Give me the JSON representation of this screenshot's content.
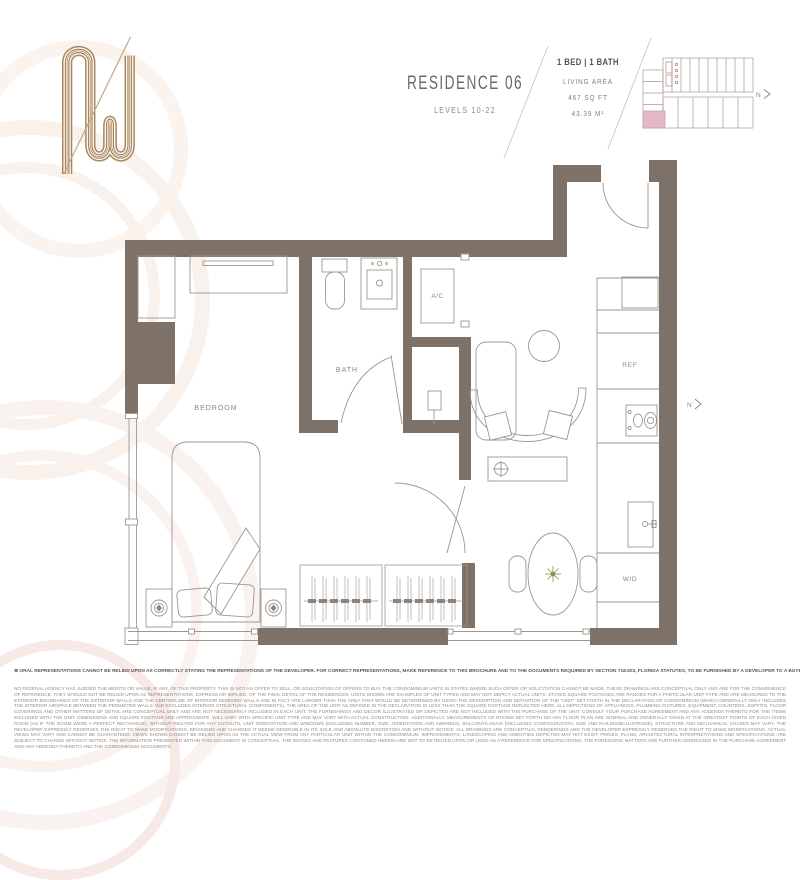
{
  "brand": {
    "logo": "w-monogram",
    "logo_color": "#a8865a"
  },
  "header": {
    "title": "RESIDENCE 06",
    "subtitle": "LEVELS 10-22",
    "stats": {
      "beds_baths": "1 BED | 1 BATH",
      "living_area_label": "LIVING AREA",
      "area_sqft": "467 SQ FT",
      "area_sqm": "43.39 M²"
    }
  },
  "keyplan": {
    "highlight_color": "#e4b9c6",
    "north_label": "N"
  },
  "floorplan": {
    "wall_color": "#7d7168",
    "labels": {
      "bedroom": "BEDROOM",
      "bath": "BATH",
      "ac": "A/C",
      "ref": "REF",
      "wd": "W/D"
    },
    "north_label": "N"
  },
  "disclaimer": {
    "bold_line": "⊕ ORAL REPRESENTATIONS CANNOT BE RELIED UPON AS CORRECTLY STATING THE REPRESENTATIONS OF THE DEVELOPER. FOR CORRECT REPRESENTATIONS, MAKE REFERENCE TO THIS BROCHURE AND TO THE DOCUMENTS REQUIRED BY SECTION 718.503, FLORIDA STATUTES, TO BE FURNISHED BY A DEVELOPER TO A BUYER OR LESSEE.",
    "body": "NO FEDERAL AGENCY HAS JUDGED THE MERITS OR VALUE, IF ANY, OF THIS PROPERTY. THIS IS NOT AN OFFER TO SELL, OR SOLICITATION OF OFFERS TO BUY, THE CONDOMINIUM UNITS IN STATES WHERE SUCH OFFER OR SOLICITATION CANNOT BE MADE. THESE DRAWINGS ARE CONCEPTUAL ONLY AND ARE FOR THE CONVENIENCE OF REFERENCE. THEY SHOULD NOT BE RELIED UPON AS REPRESENTATIONS, EXPRESS OR IMPLIED, OF THE FINAL DETAIL OF THE RESIDENCES. UNITS SHOWN ARE EXAMPLES OF UNIT TYPES AND MAY NOT DEPICT ACTUAL UNITS. STATED SQUARE FOOTAGES ARE RANGES FOR A PARTICULAR UNIT TYPE AND ARE MEASURED TO THE EXTERIOR BOUNDARIES OF THE EXTERIOR WALLS AND THE CENTERLINE OF INTERIOR DEMISING WALLS AND IN FACT ARE LARGER THAN THE AREA THAT WOULD BE DETERMINED BY USING THE DESCRIPTION AND DEFINITION OF THE \"UNIT\" SET FORTH IN THE DECLARATION OF CONDOMINIUM (WHICH GENERALLY ONLY INCLUDES THE INTERIOR AIRSPACE BETWEEN THE PERIMETER WALLS AND EXCLUDES INTERIOR STRUCTURAL COMPONENTS). THE AREA OF THE UNIT AS DEFINED IN THE DECLARATION IS LESS THAN THE SQUARE FOOTAGE REFLECTED HERE. ALL DEPICTIONS OF APPLIANCES, PLUMBING FIXTURES, EQUIPMENT, COUNTERS, SOFFITS, FLOOR COVERINGS AND OTHER MATTERS OF DETAIL ARE CONCEPTUAL ONLY AND ARE NOT NECESSARILY INCLUDED IN EACH UNIT. THE FURNISHINGS AND DECOR ILLUSTRATED OR DEPICTED ARE NOT INCLUDED WITH THE PURCHASE OF THE UNIT. CONSULT YOUR PURCHASE AGREEMENT AND ANY ADDENDA THERETO FOR THE ITEMS INCLUDED WITH THE UNIT. DIMENSIONS AND SQUARE FOOTAGE ARE APPROXIMATE, WILL VARY WITH SPECIFIC UNIT TYPE AND MAY VARY WITH ACTUAL CONSTRUCTION. ADDITIONALLY, MEASUREMENTS OF ROOMS SET FORTH ON ANY FLOOR PLAN ARE NOMINAL AND GENERALLY TAKEN AT THE GREATEST POINTS OF EACH GIVEN ROOM (AS IF THE ROOM WERE A PERFECT RECTANGLE), WITHOUT REGARD FOR ANY CUTOUTS, UNIT ORIENTATION AND WINDOWS (INCLUDING NUMBER, SIZE, ORIENTATION AND AWNINGS). BALCONY/LANAIS (INCLUDING CONFIGURATION, SIZE AND RAILING/BALUSTRADE), STRUCTURE AND MECHANICAL CHASES MAY VARY. THE DEVELOPER EXPRESSLY RESERVES THE RIGHT TO MAKE MODIFICATIONS, REVISIONS AND CHANGES IT DEEMS DESIRABLE IN ITS SOLE AND ABSOLUTE DISCRETION AND WITHOUT NOTICE. ALL DRAWINGS ARE CONCEPTUAL RENDERINGS AND THE DEVELOPER EXPRESSLY RESERVES THE RIGHT TO MAKE MODIFICATIONS. ACTUAL VIEWS MAY VARY AND CANNOT BE GUARANTEED. VIEWS SHOWN CANNOT BE RELIED UPON AS THE ACTUAL VIEW FROM ANY PARTICULAR UNIT WITHIN THE CONDOMINIUM. IMPROVEMENTS, LANDSCAPING AND AMENITIES DEPICTED MAY NOT EXIST. PRICES, PLANS, ARCHITECTURAL INTERPRETATIONS AND SPECIFICATIONS ARE SUBJECT TO CHANGE WITHOUT NOTICE. THE INFORMATION PRESENTED WITHIN THIS DOCUMENT IS CONCEPTUAL. THE IMAGES AND FEATURES CONTAINED HEREIN ARE NOT TO BE RELIED UPON OR USED AS A REFERENCE FOR SPECIFICATIONS. THE FOREGOING MATTERS ARE FURTHER ADDRESSED IN THE PURCHASE AGREEMENT AND ANY ADDENDA THERETO AND THE CONDOMINIUM DOCUMENTS."
  }
}
